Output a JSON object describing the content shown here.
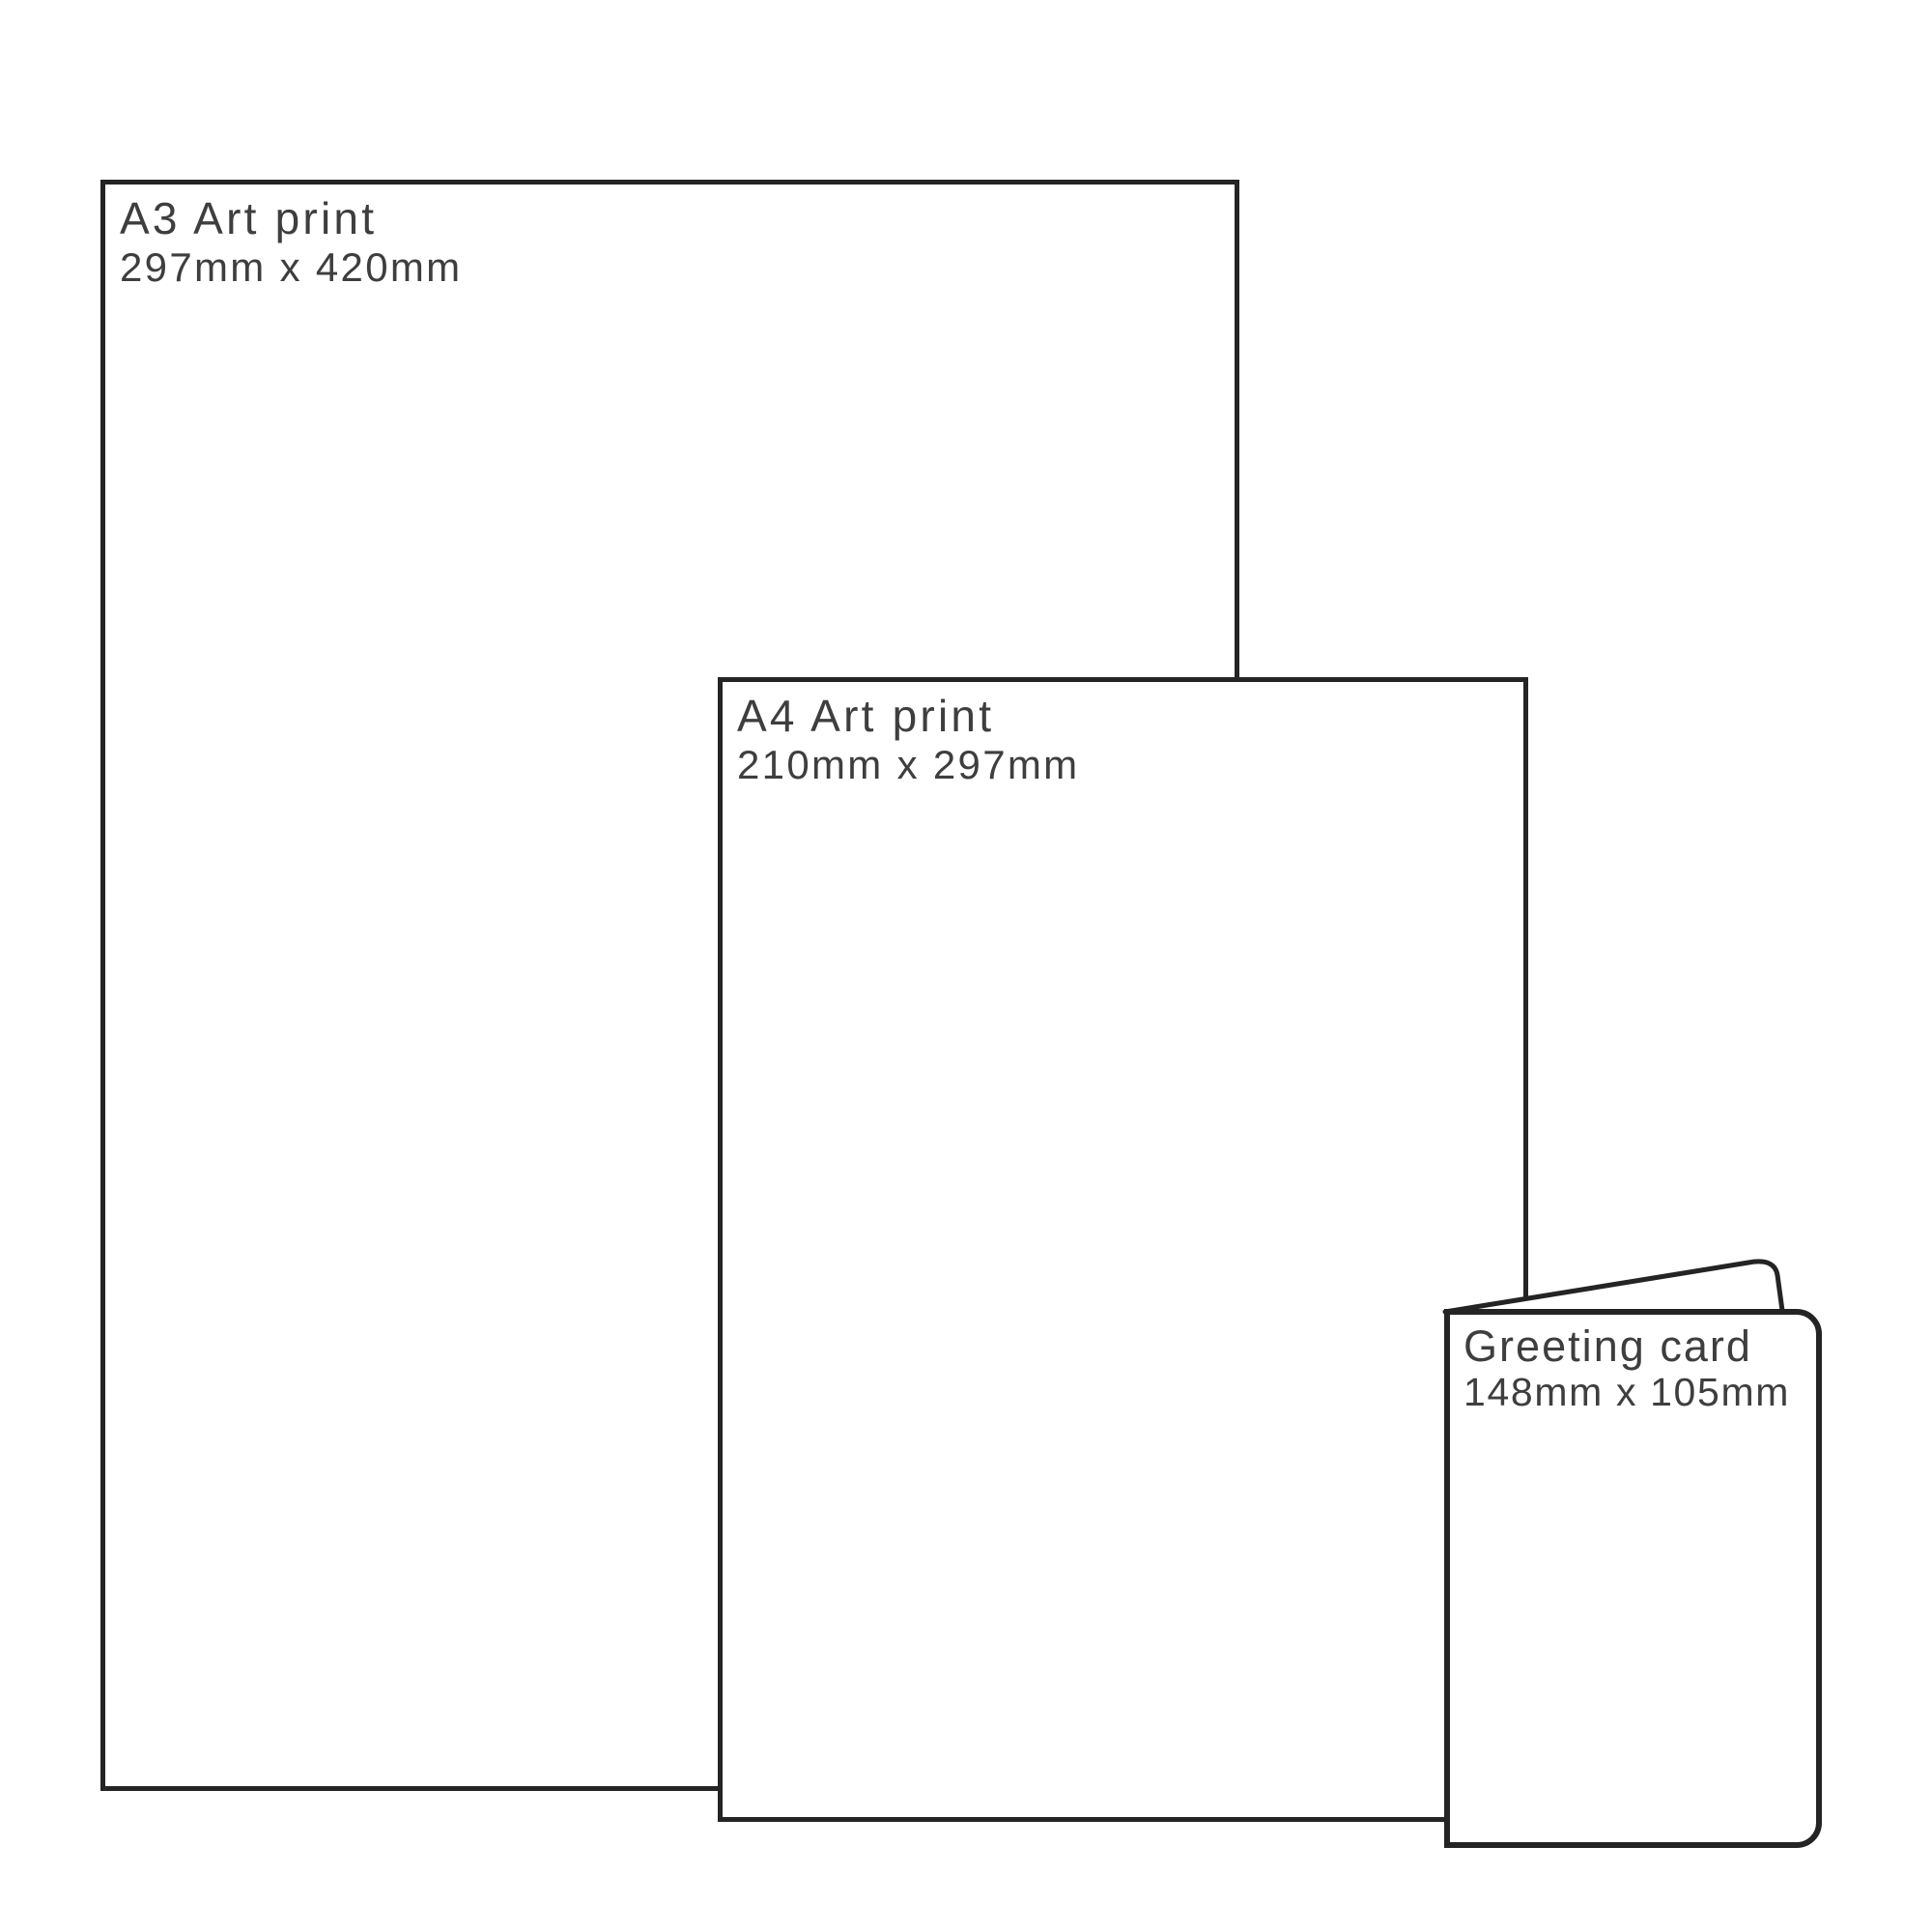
{
  "diagram": {
    "description": "Print size comparison diagram",
    "items": [
      {
        "id": "a3-print",
        "title": "A3 Art print",
        "dimensions": "297mm x 420mm"
      },
      {
        "id": "a4-print",
        "title": "A4 Art print",
        "dimensions": "210mm x 297mm"
      },
      {
        "id": "greeting-card",
        "title": "Greeting card",
        "dimensions": "148mm x 105mm"
      }
    ],
    "colors": {
      "background": "#ffffff",
      "stroke": "#242424",
      "text": "#3e3e3e"
    }
  }
}
